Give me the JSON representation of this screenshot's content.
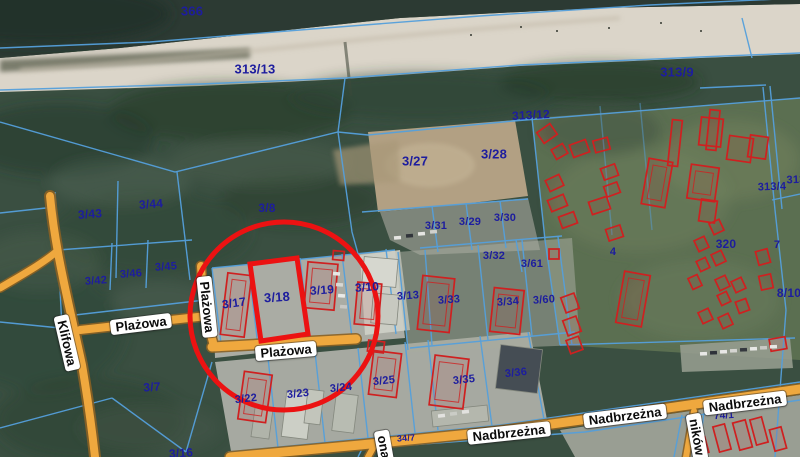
{
  "map": {
    "highlight": {
      "parcel": "3/18",
      "color": "#ec1212",
      "stroke_width": 5,
      "circle": {
        "cx": 284,
        "cy": 316,
        "r": 94
      },
      "rect_points": "250,264 297,258 308,334 261,341"
    },
    "colors": {
      "boundary_line": "#55a0dc",
      "parcel_label": "#1d1d9e",
      "building_outline": "#cf2020",
      "road_fill": "#efa83e",
      "road_casing": "#8a6124",
      "beach": "#dbd5c9",
      "water": "#2c3a33",
      "forest": "#3a4f41"
    },
    "parcel_labels": [
      {
        "text": "366",
        "x": 192,
        "y": 11,
        "size": 13,
        "rot": 0
      },
      {
        "text": "313/13",
        "x": 255,
        "y": 69,
        "size": 13,
        "rot": 0
      },
      {
        "text": "313/9",
        "x": 677,
        "y": 72,
        "size": 13,
        "rot": 0
      },
      {
        "text": "313/12",
        "x": 531,
        "y": 115,
        "size": 12,
        "rot": -3
      },
      {
        "text": "3/27",
        "x": 415,
        "y": 161,
        "size": 13,
        "rot": 0
      },
      {
        "text": "3/28",
        "x": 494,
        "y": 154,
        "size": 13,
        "rot": 0
      },
      {
        "text": "3/8",
        "x": 267,
        "y": 208,
        "size": 12,
        "rot": 0
      },
      {
        "text": "3/43",
        "x": 90,
        "y": 214,
        "size": 12,
        "rot": -4
      },
      {
        "text": "3/44",
        "x": 151,
        "y": 204,
        "size": 12,
        "rot": -4
      },
      {
        "text": "3/42",
        "x": 96,
        "y": 281,
        "size": 11,
        "rot": -4
      },
      {
        "text": "3/46",
        "x": 131,
        "y": 274,
        "size": 11,
        "rot": -4
      },
      {
        "text": "3/45",
        "x": 166,
        "y": 267,
        "size": 11,
        "rot": -4
      },
      {
        "text": "3/31",
        "x": 436,
        "y": 226,
        "size": 11,
        "rot": 0
      },
      {
        "text": "3/29",
        "x": 470,
        "y": 222,
        "size": 11,
        "rot": 0
      },
      {
        "text": "3/30",
        "x": 505,
        "y": 218,
        "size": 11,
        "rot": 0
      },
      {
        "text": "3/32",
        "x": 494,
        "y": 256,
        "size": 11,
        "rot": 0
      },
      {
        "text": "3/61",
        "x": 532,
        "y": 264,
        "size": 11,
        "rot": 0
      },
      {
        "text": "3/17",
        "x": 234,
        "y": 303,
        "size": 12,
        "rot": -8
      },
      {
        "text": "3/18",
        "x": 277,
        "y": 297,
        "size": 13,
        "rot": -4
      },
      {
        "text": "3/19",
        "x": 322,
        "y": 290,
        "size": 12,
        "rot": -4
      },
      {
        "text": "3/10",
        "x": 367,
        "y": 287,
        "size": 12,
        "rot": -4
      },
      {
        "text": "3/13",
        "x": 408,
        "y": 296,
        "size": 11,
        "rot": -4
      },
      {
        "text": "3/33",
        "x": 449,
        "y": 300,
        "size": 11,
        "rot": -4
      },
      {
        "text": "3/34",
        "x": 508,
        "y": 302,
        "size": 11,
        "rot": -4
      },
      {
        "text": "3/60",
        "x": 544,
        "y": 300,
        "size": 11,
        "rot": -4
      },
      {
        "text": "320",
        "x": 726,
        "y": 244,
        "size": 12,
        "rot": 0
      },
      {
        "text": "4",
        "x": 613,
        "y": 252,
        "size": 11,
        "rot": 0
      },
      {
        "text": "7",
        "x": 777,
        "y": 245,
        "size": 11,
        "rot": 0
      },
      {
        "text": "313/4",
        "x": 772,
        "y": 187,
        "size": 11,
        "rot": -2
      },
      {
        "text": "313",
        "x": 796,
        "y": 180,
        "size": 11,
        "rot": -2
      },
      {
        "text": "8/10",
        "x": 789,
        "y": 293,
        "size": 12,
        "rot": 0
      },
      {
        "text": "3/7",
        "x": 152,
        "y": 387,
        "size": 12,
        "rot": -4
      },
      {
        "text": "3/16",
        "x": 181,
        "y": 453,
        "size": 12,
        "rot": -4
      },
      {
        "text": "3/22",
        "x": 246,
        "y": 399,
        "size": 11,
        "rot": -6
      },
      {
        "text": "3/23",
        "x": 298,
        "y": 394,
        "size": 11,
        "rot": -6
      },
      {
        "text": "3/24",
        "x": 341,
        "y": 388,
        "size": 11,
        "rot": -6
      },
      {
        "text": "3/25",
        "x": 384,
        "y": 381,
        "size": 11,
        "rot": -6
      },
      {
        "text": "3/35",
        "x": 464,
        "y": 380,
        "size": 11,
        "rot": -6
      },
      {
        "text": "3/36",
        "x": 516,
        "y": 373,
        "size": 11,
        "rot": -6
      },
      {
        "text": "34/7",
        "x": 406,
        "y": 438,
        "size": 9,
        "rot": -4
      },
      {
        "text": "74/1",
        "x": 724,
        "y": 416,
        "size": 10,
        "rot": -4
      }
    ],
    "street_labels": [
      {
        "text": "Klifowa",
        "x": 67,
        "y": 343,
        "rot": 77
      },
      {
        "text": "Plażowa",
        "x": 141,
        "y": 324,
        "rot": -7
      },
      {
        "text": "Plażowa",
        "x": 207,
        "y": 307,
        "rot": 84
      },
      {
        "text": "Plażowa",
        "x": 286,
        "y": 351,
        "rot": -5
      },
      {
        "text": "Nadbrzeżna",
        "x": 509,
        "y": 433,
        "rot": -6
      },
      {
        "text": "Nadbrzeżna",
        "x": 625,
        "y": 416,
        "rot": -7
      },
      {
        "text": "Nadbrzeżna",
        "x": 745,
        "y": 403,
        "rot": -7
      },
      {
        "text": "ona",
        "x": 384,
        "y": 447,
        "rot": 80
      },
      {
        "text": "ników",
        "x": 697,
        "y": 437,
        "rot": 80
      }
    ],
    "buildings_red": [
      [
        224,
        274,
        24,
        62,
        7
      ],
      [
        306,
        263,
        30,
        46,
        5
      ],
      [
        356,
        283,
        24,
        42,
        5
      ],
      [
        333,
        251,
        11,
        9,
        5
      ],
      [
        241,
        373,
        28,
        48,
        8
      ],
      [
        368,
        341,
        16,
        11,
        7
      ],
      [
        371,
        352,
        28,
        44,
        7
      ],
      [
        432,
        357,
        34,
        50,
        7
      ],
      [
        420,
        277,
        32,
        54,
        6
      ],
      [
        492,
        289,
        30,
        44,
        6
      ],
      [
        549,
        249,
        10,
        10,
        0
      ],
      [
        539,
        127,
        16,
        13,
        -35
      ],
      [
        553,
        146,
        13,
        11,
        -30
      ],
      [
        571,
        142,
        17,
        13,
        -20
      ],
      [
        594,
        139,
        15,
        12,
        -15
      ],
      [
        547,
        177,
        15,
        12,
        -25
      ],
      [
        549,
        197,
        17,
        12,
        -22
      ],
      [
        560,
        214,
        16,
        12,
        -20
      ],
      [
        590,
        199,
        19,
        13,
        -18
      ],
      [
        602,
        166,
        15,
        12,
        -20
      ],
      [
        605,
        184,
        14,
        11,
        -20
      ],
      [
        607,
        227,
        15,
        12,
        -18
      ],
      [
        700,
        118,
        22,
        28,
        6
      ],
      [
        708,
        110,
        10,
        40,
        6
      ],
      [
        645,
        160,
        24,
        46,
        10
      ],
      [
        670,
        120,
        10,
        46,
        6
      ],
      [
        689,
        166,
        28,
        34,
        8
      ],
      [
        728,
        137,
        24,
        24,
        8
      ],
      [
        749,
        136,
        18,
        22,
        8
      ],
      [
        700,
        200,
        16,
        22,
        8
      ],
      [
        711,
        221,
        11,
        12,
        -25
      ],
      [
        696,
        238,
        11,
        12,
        -25
      ],
      [
        713,
        252,
        11,
        12,
        -25
      ],
      [
        698,
        259,
        10,
        11,
        -25
      ],
      [
        717,
        277,
        11,
        12,
        -25
      ],
      [
        733,
        279,
        11,
        12,
        -25
      ],
      [
        719,
        293,
        10,
        11,
        -25
      ],
      [
        690,
        276,
        10,
        12,
        -25
      ],
      [
        757,
        250,
        12,
        14,
        -15
      ],
      [
        760,
        275,
        12,
        14,
        -12
      ],
      [
        700,
        310,
        11,
        12,
        -25
      ],
      [
        720,
        315,
        11,
        12,
        -25
      ],
      [
        737,
        300,
        11,
        12,
        -20
      ],
      [
        620,
        273,
        26,
        52,
        10
      ],
      [
        563,
        295,
        14,
        16,
        -20
      ],
      [
        565,
        318,
        14,
        16,
        -20
      ],
      [
        568,
        338,
        13,
        14,
        -20
      ],
      [
        716,
        425,
        12,
        26,
        -15
      ],
      [
        736,
        421,
        13,
        28,
        -15
      ],
      [
        753,
        418,
        12,
        26,
        -15
      ],
      [
        772,
        428,
        12,
        22,
        -15
      ],
      [
        695,
        438,
        12,
        16,
        -15
      ],
      [
        770,
        338,
        16,
        12,
        -10
      ]
    ],
    "buildings_gray": [
      [
        284,
        392,
        26,
        46,
        7,
        "#cccfc6"
      ],
      [
        334,
        394,
        22,
        38,
        7,
        "#b8bcb2"
      ],
      [
        306,
        390,
        16,
        34,
        7,
        "#c2c5bb"
      ],
      [
        498,
        347,
        42,
        44,
        7,
        "#454d54"
      ],
      [
        363,
        258,
        34,
        28,
        5,
        "#d6d7cf"
      ],
      [
        372,
        294,
        26,
        30,
        5,
        "#c7c9c0"
      ],
      [
        253,
        408,
        18,
        30,
        8,
        "#b0b4aa"
      ],
      [
        432,
        408,
        56,
        16,
        -6,
        "#b4b7ad"
      ]
    ],
    "cars": [
      [
        333,
        272,
        5,
        "#e8e8e6"
      ],
      [
        336,
        283,
        5,
        "#d8d8d4"
      ],
      [
        338,
        294,
        5,
        "#eaeae8"
      ],
      [
        340,
        305,
        5,
        "#c8c8c4"
      ],
      [
        394,
        236,
        -5,
        "#e5e5e2"
      ],
      [
        406,
        234,
        -5,
        "#30343a"
      ],
      [
        418,
        232,
        -5,
        "#e5e5e2"
      ],
      [
        430,
        230,
        -5,
        "#d0d0cc"
      ],
      [
        700,
        352,
        -3,
        "#e8e8e6"
      ],
      [
        710,
        351,
        -3,
        "#2e323a"
      ],
      [
        720,
        350,
        -3,
        "#e8e8e6"
      ],
      [
        730,
        349,
        -3,
        "#d5d5d1"
      ],
      [
        740,
        348,
        -3,
        "#34383e"
      ],
      [
        750,
        347,
        -3,
        "#e8e8e6"
      ],
      [
        760,
        346,
        -3,
        "#c9c9c5"
      ],
      [
        770,
        345,
        -3,
        "#e8e8e6"
      ],
      [
        438,
        414,
        -6,
        "#e2e2df"
      ],
      [
        450,
        412,
        -6,
        "#caccc6"
      ],
      [
        462,
        410,
        -6,
        "#e2e2df"
      ]
    ]
  }
}
